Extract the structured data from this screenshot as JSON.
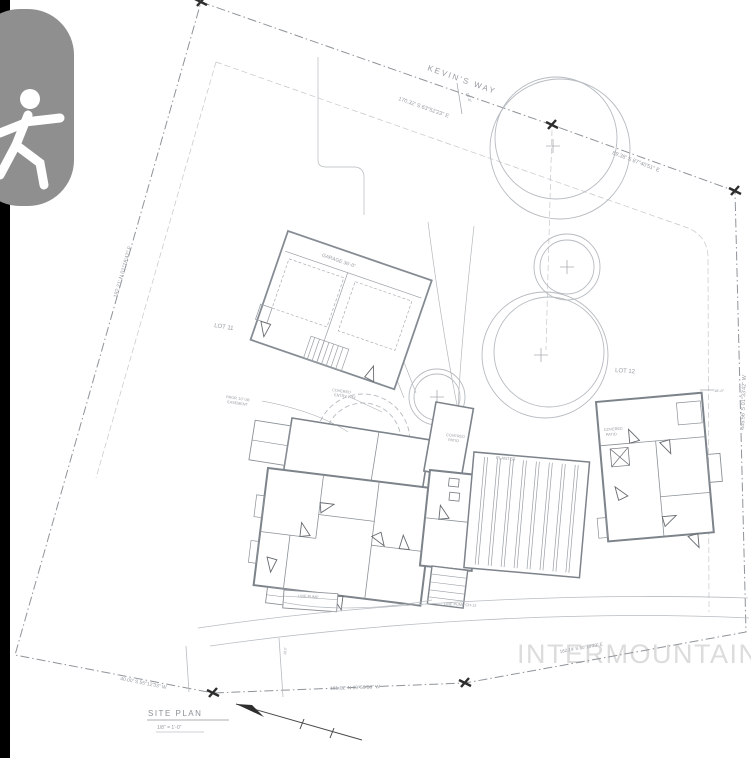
{
  "viewer": {
    "badge_icon": "walking-person-icon",
    "colors": {
      "edge_bar": "#000000",
      "badge_bg": "#8f8f8f",
      "badge_glyph": "#ffffff"
    }
  },
  "drawing": {
    "watermark": "INTERMOUNTAIN",
    "title_block": {
      "title": "SITE PLAN",
      "scale": "1/8\" = 1'-0\""
    },
    "annotations": {
      "street": "KEVIN'S WAY",
      "bearing_top": "170.32' S 63°52'23\" E",
      "bearing_top_right": "89.38' S 87°40'51\" E",
      "bearing_left": "182.21' N 01°18'47\" E",
      "bearing_right": "445.56' S 01°33'42\" W",
      "bearing_bottom": "161.02' N 89°59'58\" W",
      "bearing_bottom_left": "40.00' S 55°12'33\" W",
      "bearing_bottom_right": "162.19' S 80°10'23\" E",
      "lot_left": "LOT 11",
      "lot_right": "LOT 12",
      "dim_top": "16'-0\"",
      "dim_right": "16'-0\"",
      "dim_bottom": "18.0'",
      "garage": "GARAGE 36'-0\"",
      "note_prop_line1": "PROP. 10' UB",
      "note_prop_line2": "EASEMENT",
      "covered_line1": "COVERED",
      "covered_line2": "ENTRY WAY",
      "patio_a_line1": "COVERED",
      "patio_a_line2": "PATIO",
      "patio_b_line1": "COVERED",
      "patio_b_line2": "PATIO",
      "planter": "PLANTER",
      "pump_left": "LINE PUMP",
      "pump_right": "LINE PUMP CH-12"
    },
    "colors": {
      "boundary": "#8f949a",
      "setback": "#c3c7cb",
      "walls": "#7d838a",
      "trees": "#b6bbc0",
      "text": "#8b9197",
      "watermark": "#dcdcdc",
      "marker": "#2e2e2e"
    }
  }
}
